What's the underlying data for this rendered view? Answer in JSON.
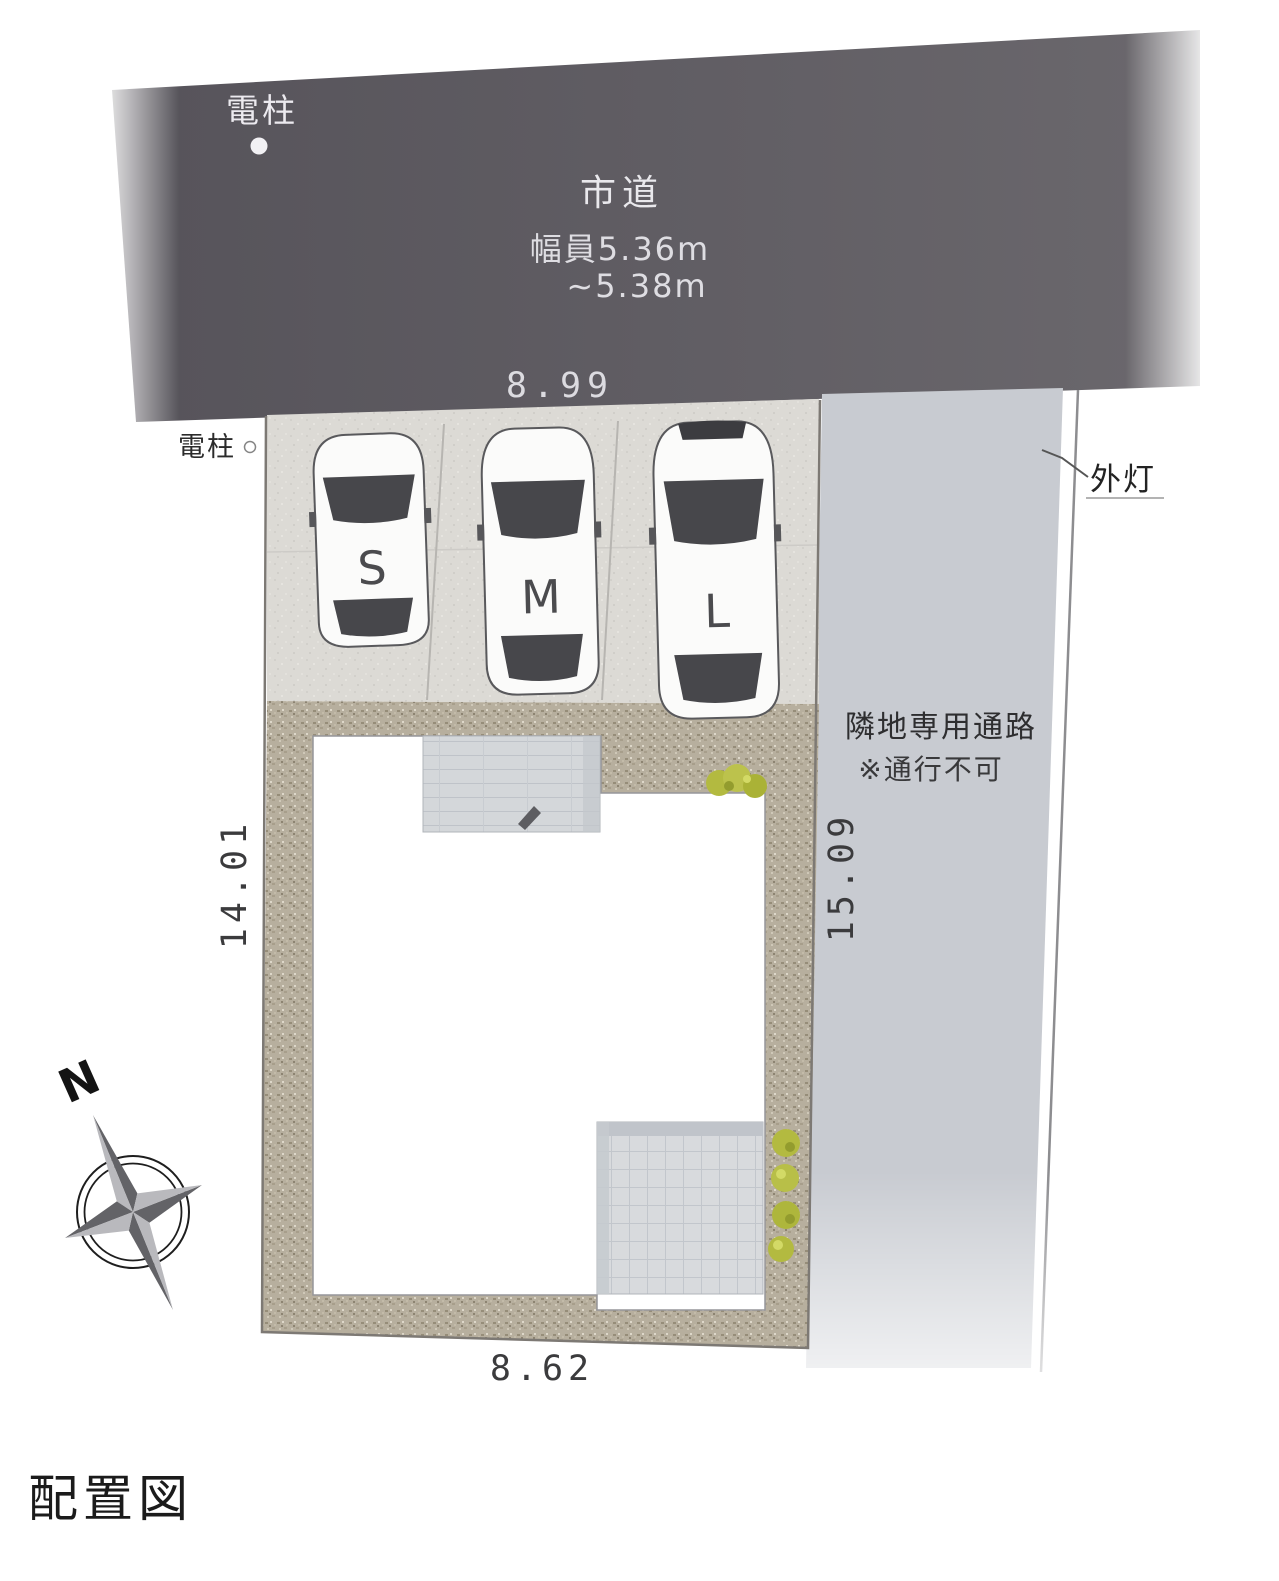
{
  "page_title": "配置図",
  "road": {
    "label": "市道",
    "width_note_line1": "幅員5.36m",
    "width_note_line2": "~5.38m",
    "frontage_dimension": "8.99",
    "utility_pole_label": "電柱"
  },
  "site": {
    "utility_pole_label": "電柱",
    "left_dimension": "14.01",
    "right_dimension": "15.09",
    "bottom_dimension": "8.62"
  },
  "parking_stalls": [
    {
      "label": "S"
    },
    {
      "label": "M"
    },
    {
      "label": "L"
    }
  ],
  "passage": {
    "label": "隣地専用通路",
    "note": "※通行不可",
    "outdoor_light_label": "外灯"
  },
  "compass": {
    "north_label": "N"
  },
  "colors": {
    "road": "#5d5a60",
    "parking_surface": "#dcdad5",
    "gravel": "#b7af9e",
    "building": "#ffffff",
    "passage_corridor": "#c8cbd1",
    "tile": "#d5d8db",
    "bush": "#b3ba40"
  }
}
